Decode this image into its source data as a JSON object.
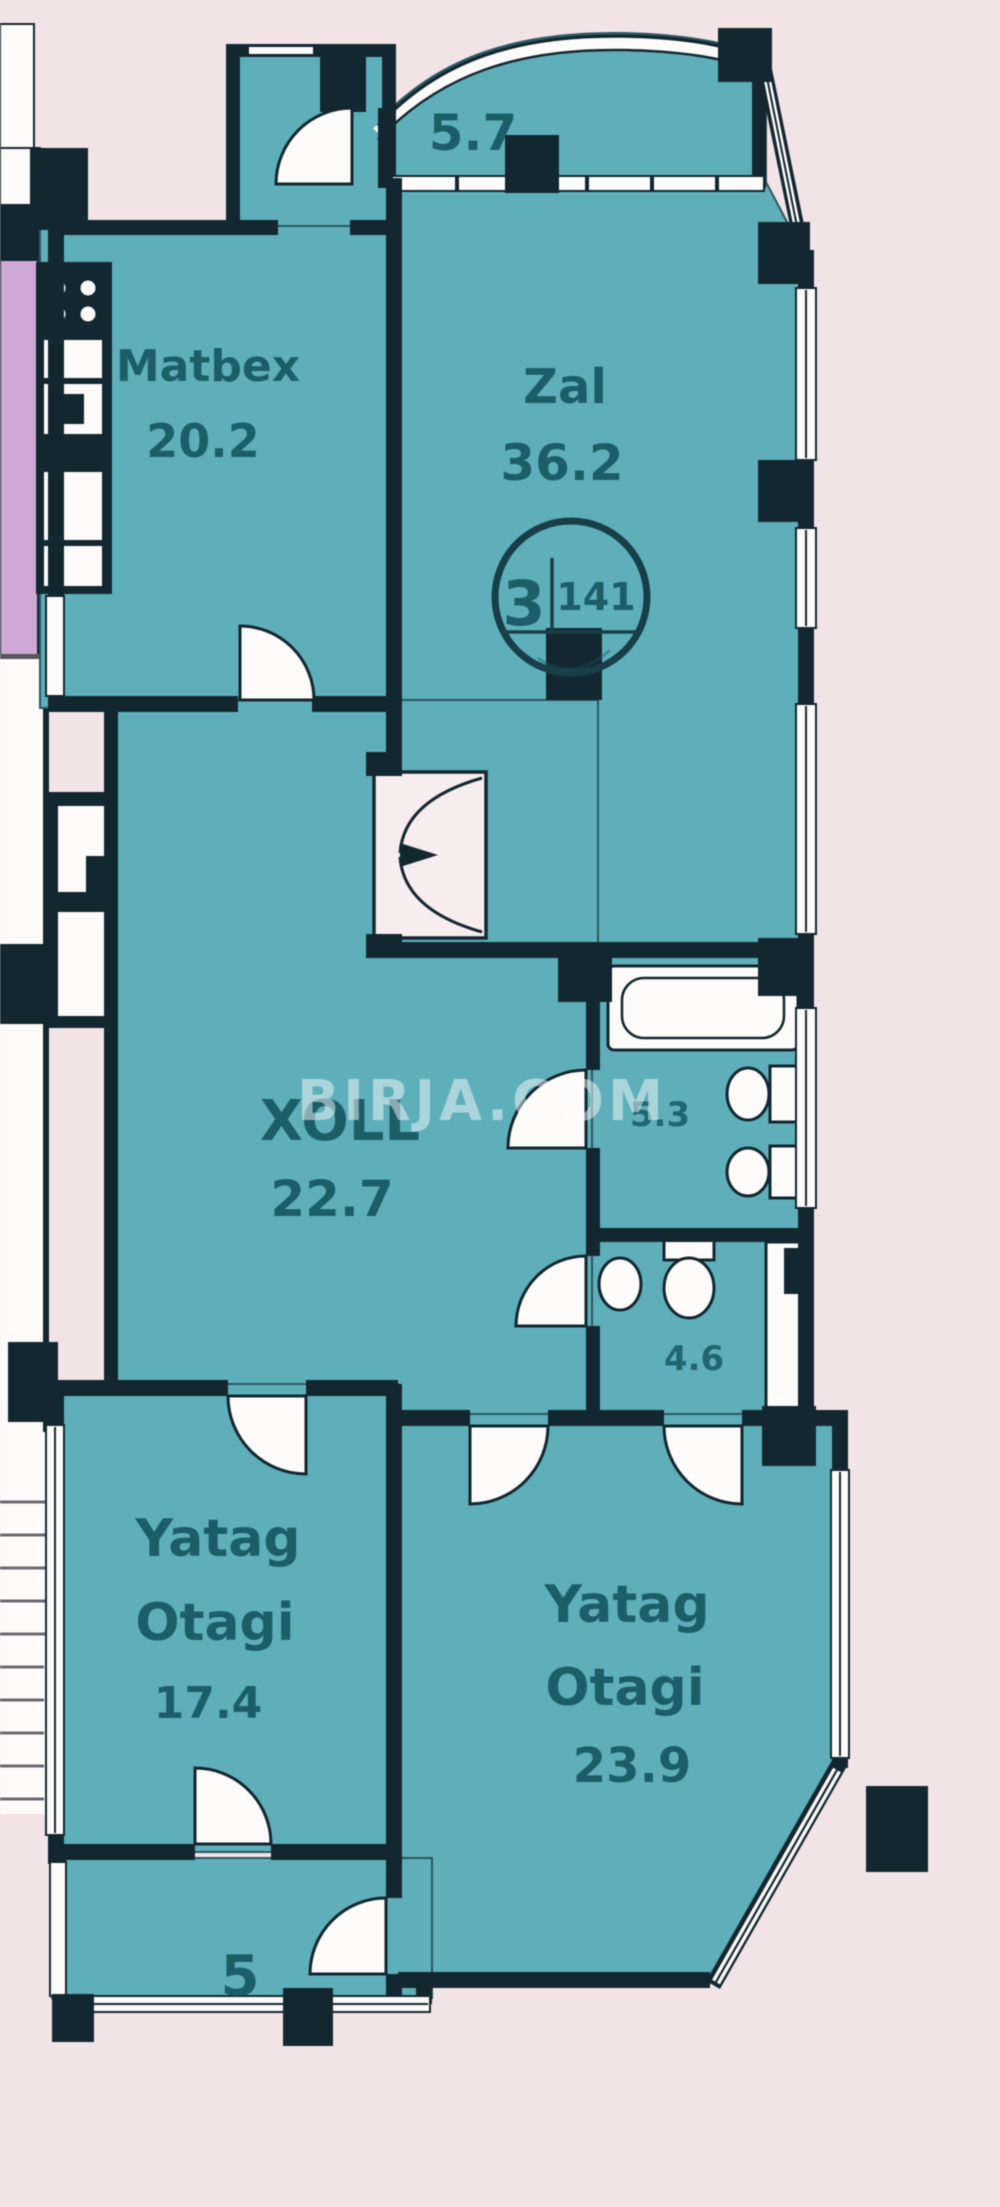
{
  "document": {
    "type": "apartment-floor-plan"
  },
  "colors": {
    "background": "#f2e3e6",
    "room_fill": "#5cb0bb",
    "room_edge": "#2a565f",
    "wall": "#132730",
    "label_text": "#155863",
    "badge_ring": "#173f49",
    "neighbor_fill": "#cfa9d6",
    "watermark_color": "#ffffff",
    "stair_line": "#6d6770",
    "white": "#fdfbfa"
  },
  "watermark": {
    "text": "BIRJA.COM"
  },
  "badge": {
    "room_count": "3",
    "total_area": "141"
  },
  "rooms": {
    "balcony_top": {
      "area": "5.7"
    },
    "kitchen": {
      "name": "Matbex",
      "area": "20.2"
    },
    "living_room": {
      "name": "Zal",
      "area": "36.2"
    },
    "hall": {
      "name": "XOLL",
      "area": "22.7"
    },
    "bathroom": {
      "area": "5.3"
    },
    "wc": {
      "area": "4.6"
    },
    "bedroom_1": {
      "name_line1": "Yatag",
      "name_line2": "Otagi",
      "area": "17.4"
    },
    "bedroom_2": {
      "name_line1": "Yatag",
      "name_line2": "Otagi",
      "area": "23.9"
    },
    "balcony_bottom": {
      "area": "5"
    }
  }
}
